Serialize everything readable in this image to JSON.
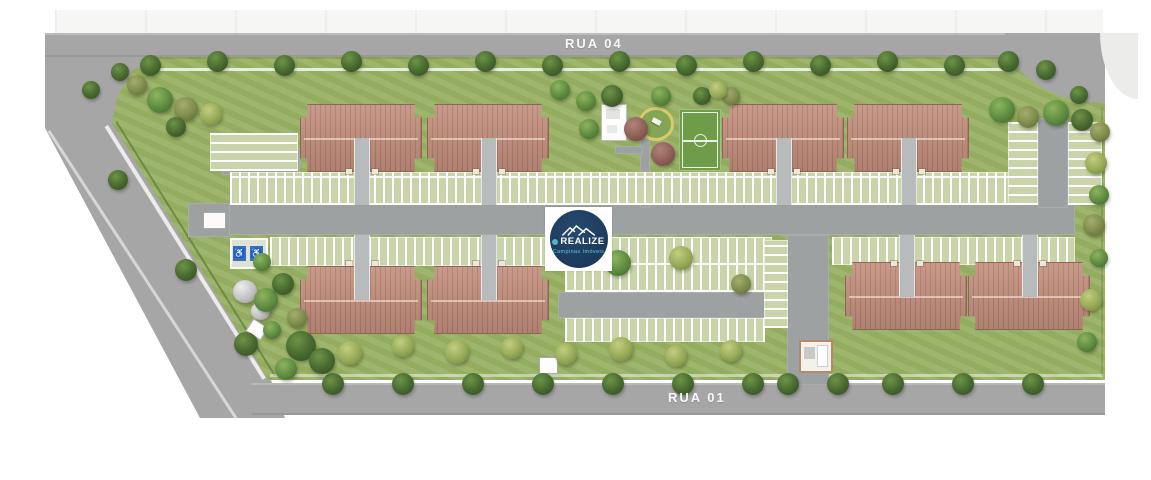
{
  "streets": {
    "top": "RUA 04",
    "bottom": "RUA 01"
  },
  "logo": {
    "brand": "REALIZE",
    "subtitle": "Campinas Imóveis"
  },
  "icons": {
    "wheelchair": "♿",
    "mountains": "mountain-peaks"
  },
  "colors": {
    "road": "#a6a6a6",
    "road_inner": "#9ea1a2",
    "lawn": "#98b164",
    "parking_bg": "#c9d4ab",
    "roof": "#c38f7d",
    "roof_edge": "#8e6656",
    "navy": "#1d3a5c",
    "teal": "#5ec8d8",
    "court": "#6f9c49",
    "ring": "#d8c96f",
    "blue": "#3a6fb5",
    "sidewalk": "#f1f1ef",
    "tank": "#c2c2c2"
  }
}
